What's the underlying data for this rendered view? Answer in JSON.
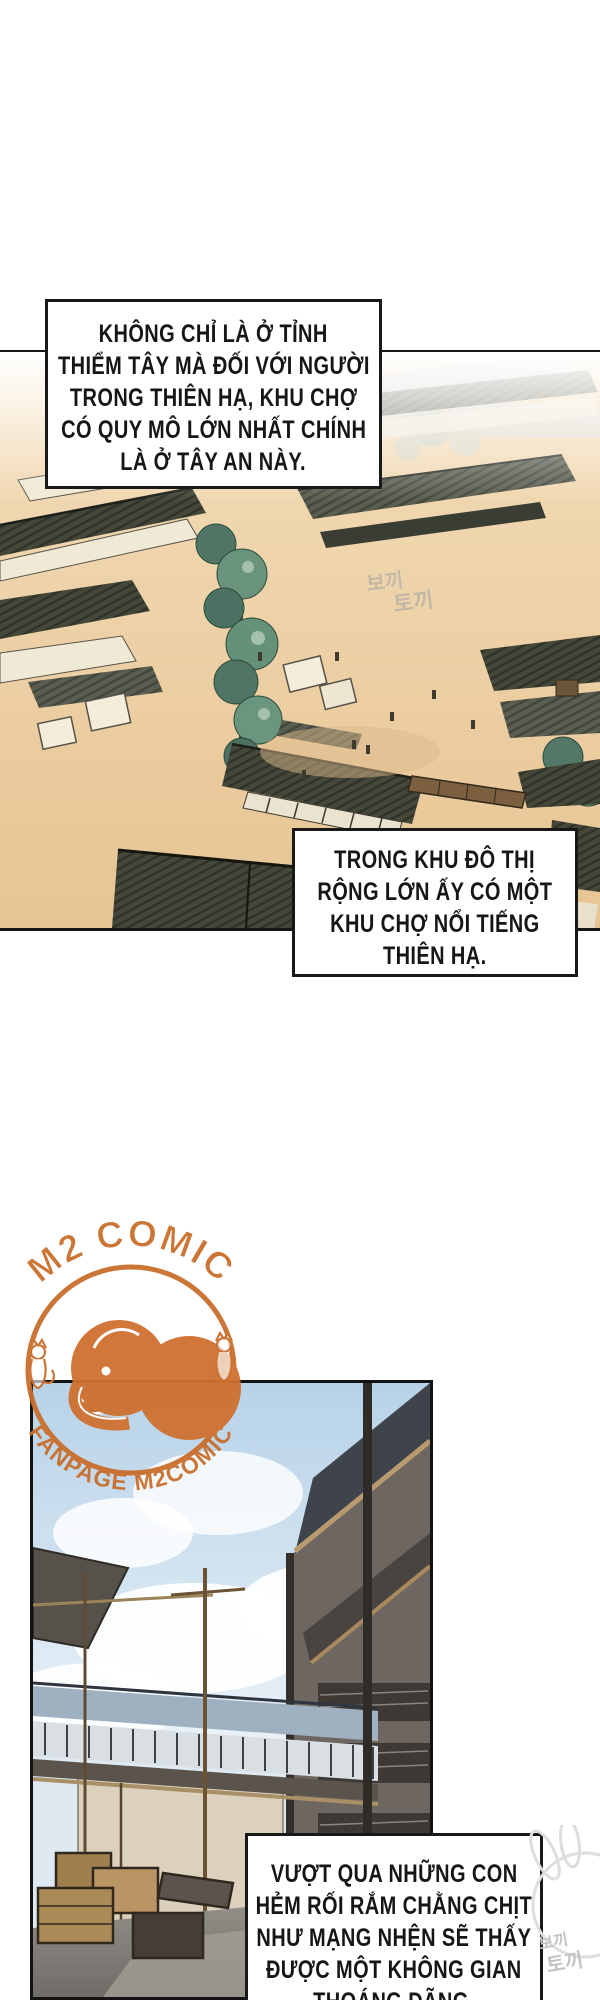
{
  "page": {
    "width": 600,
    "height": 2000,
    "background": "#ffffff"
  },
  "narration": {
    "box1": {
      "lines": [
        "KHÔNG CHỈ LÀ Ở TỈNH",
        "THIỂM TÂY MÀ ĐỐI VỚI NGƯỜI",
        "TRONG THIÊN HẠ, KHU CHỢ",
        "CÓ QUY MÔ LỚN NHẤT CHÍNH",
        "LÀ Ở TÂY AN NÀY."
      ]
    },
    "box2": {
      "lines": [
        "TRONG KHU ĐÔ THỊ",
        "RỘNG LỚN ẤY CÓ MỘT",
        "KHU CHỢ NỔI TIẾNG",
        "THIÊN HẠ."
      ]
    },
    "box3": {
      "lines": [
        "VƯỢT QUA NHỮNG CON",
        "HẺM RỐI RẮM CHẰNG CHỊT",
        "NHƯ MẠNG NHỆN SẼ THẤY",
        "ĐƯỢC MỘT KHÔNG GIAN",
        "THOÁNG ĐÃNG."
      ]
    }
  },
  "watermark": {
    "arc_top": "M2 COMIC",
    "arc_bottom": "FANPAGE M2COMIC",
    "color": "#c96e2c",
    "mascot": "elephant-with-pen",
    "side_mascot": "fox"
  },
  "corner_mark": {
    "lines": [
      "보끼",
      "토끼"
    ],
    "color": "#c4c4c4"
  },
  "panels": {
    "market": {
      "name": "market-aerial-view",
      "palette": {
        "ground": "#ecca9e",
        "roof_dark": "#454839",
        "roof_mid": "#5a5e50",
        "awning": "#f0e9d5",
        "tree": "#507565"
      }
    },
    "alley": {
      "name": "alley-perspective-view",
      "palette": {
        "sky": "#b7d2e8",
        "building": "#6e6660",
        "wall": "#dbd1bd",
        "ground": "#8e8a84"
      }
    }
  }
}
